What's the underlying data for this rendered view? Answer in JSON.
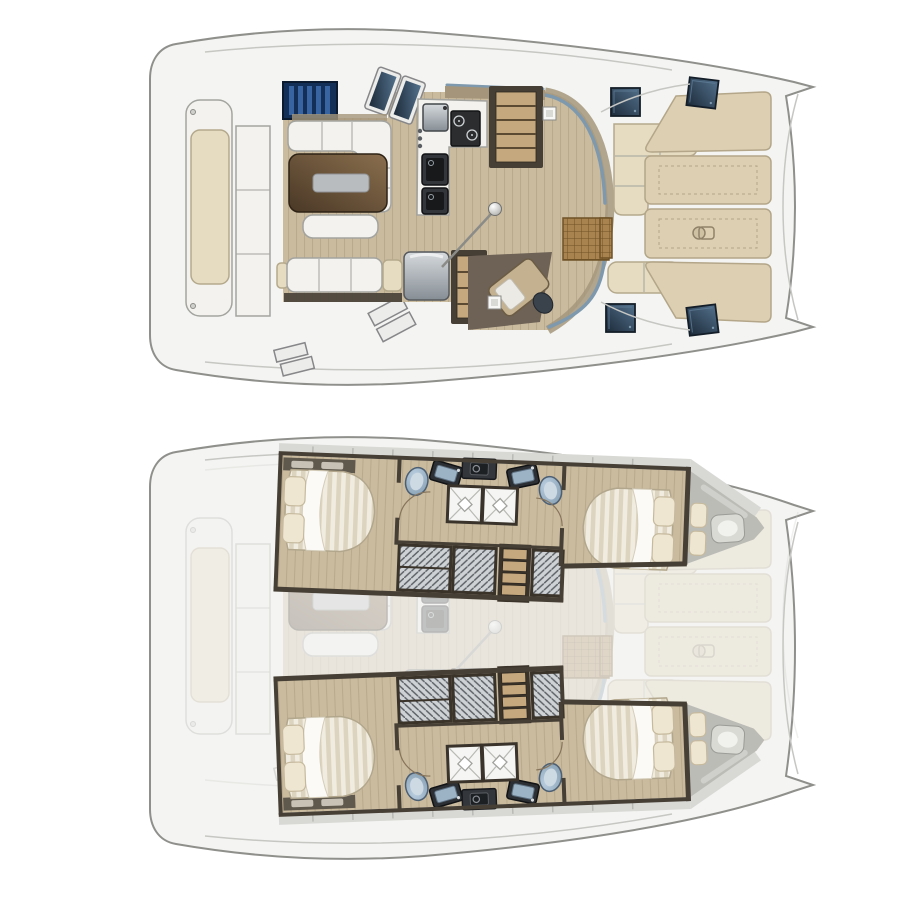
{
  "document": {
    "kind": "catamaran-yacht-floorplan",
    "text_content": [],
    "views": [
      {
        "id": "main-deck-plan",
        "position": "top",
        "elements": [
          "aft-platform-bench",
          "aft-steps",
          "cockpit-windshield",
          "skylight-hatches",
          "saloon-sofa-l",
          "dining-table",
          "serving-tray",
          "ottoman",
          "aft-sofa",
          "sofa-armrest",
          "galley-counter",
          "galley-sink",
          "galley-stove",
          "galley-appliances",
          "refrigerator",
          "companionway-stairs-port",
          "companionway-stairs-starboard",
          "chart-table",
          "nav-seat",
          "nav-light",
          "mast-base",
          "rigging-line",
          "entry-teak-mat",
          "forward-cockpit-l-sofa",
          "forward-cockpit-bench",
          "foredeck-sunpad-1",
          "foredeck-sunpad-2",
          "foredeck-sunpad-3",
          "foredeck-sunpad-4",
          "windlass",
          "deck-hatch-1",
          "deck-hatch-2",
          "deck-hatch-3",
          "deck-hatch-4",
          "bow-crossbeam",
          "transom-steps"
        ]
      },
      {
        "id": "lower-deck-plan",
        "position": "bottom",
        "elements": [
          "ghosted-main-deck",
          "port-hull",
          "starboard-hull",
          "aft-cabin-double-bed",
          "forward-cabin-double-bed",
          "bed-pillows",
          "overhead-shelf",
          "toilet-aft",
          "toilet-forward",
          "vanity-sink-aft",
          "vanity-sink-forward",
          "washing-machine",
          "shower-cubicle-aft",
          "shower-cubicle-forward",
          "door-swing-arcs",
          "hanging-wardrobes",
          "hull-companionway-stairs",
          "forepeak-berth",
          "forepeak-cushions",
          "side-walkway"
        ]
      }
    ]
  },
  "colors": {
    "canvas_bg": "#ffffff",
    "hull_fill": "#f4f4f2",
    "hull_stroke": "#8f8f8c",
    "deck_line": "#c6c6c3",
    "wood_floor": "#cabb9f",
    "wood_grain": "#b9a98d",
    "wall_dark": "#463f35",
    "wall_khaki": "#a5967b",
    "sofa_white": "#f3f2ef",
    "sofa_stroke": "#a3a39f",
    "cushion_beige": "#e6dcc2",
    "cushion_edge": "#b5a98c",
    "pad_beige": "#ddcfb1",
    "pad_edge": "#b3a689",
    "table_dark": "#4a3826",
    "table_light": "#8a6f4e",
    "tray_grey": "#b9bcbe",
    "hatch_dark": "#1d2b3a",
    "hatch_light": "#53718c",
    "windshield_navy": "#132f58",
    "windshield_stripe": "#3f6fae",
    "glass_blue": "#7e99ad",
    "teak": "#a8834f",
    "teak_line": "#6f5226",
    "stair_wood": "#c5a87d",
    "stair_frame": "#3a332a",
    "appliance_dark": "#33373c",
    "fridge_light": "#d6dadd",
    "fridge_dark": "#868e95",
    "toilet_light": "#b9cedf",
    "toilet_dark": "#7e97ab",
    "mattress_light": "#f1ece0",
    "mattress_shade": "#ddd4c0",
    "pillow_cream": "#efe6d1",
    "wardrobe_grey": "#ced2d5",
    "wardrobe_line": "#5a5f64",
    "walkway_grey": "#d8d8d5",
    "forepeak_grey": "#bcbcb7",
    "ghost_opacity": "0.26"
  },
  "canvas": {
    "width": 901,
    "height": 900
  }
}
